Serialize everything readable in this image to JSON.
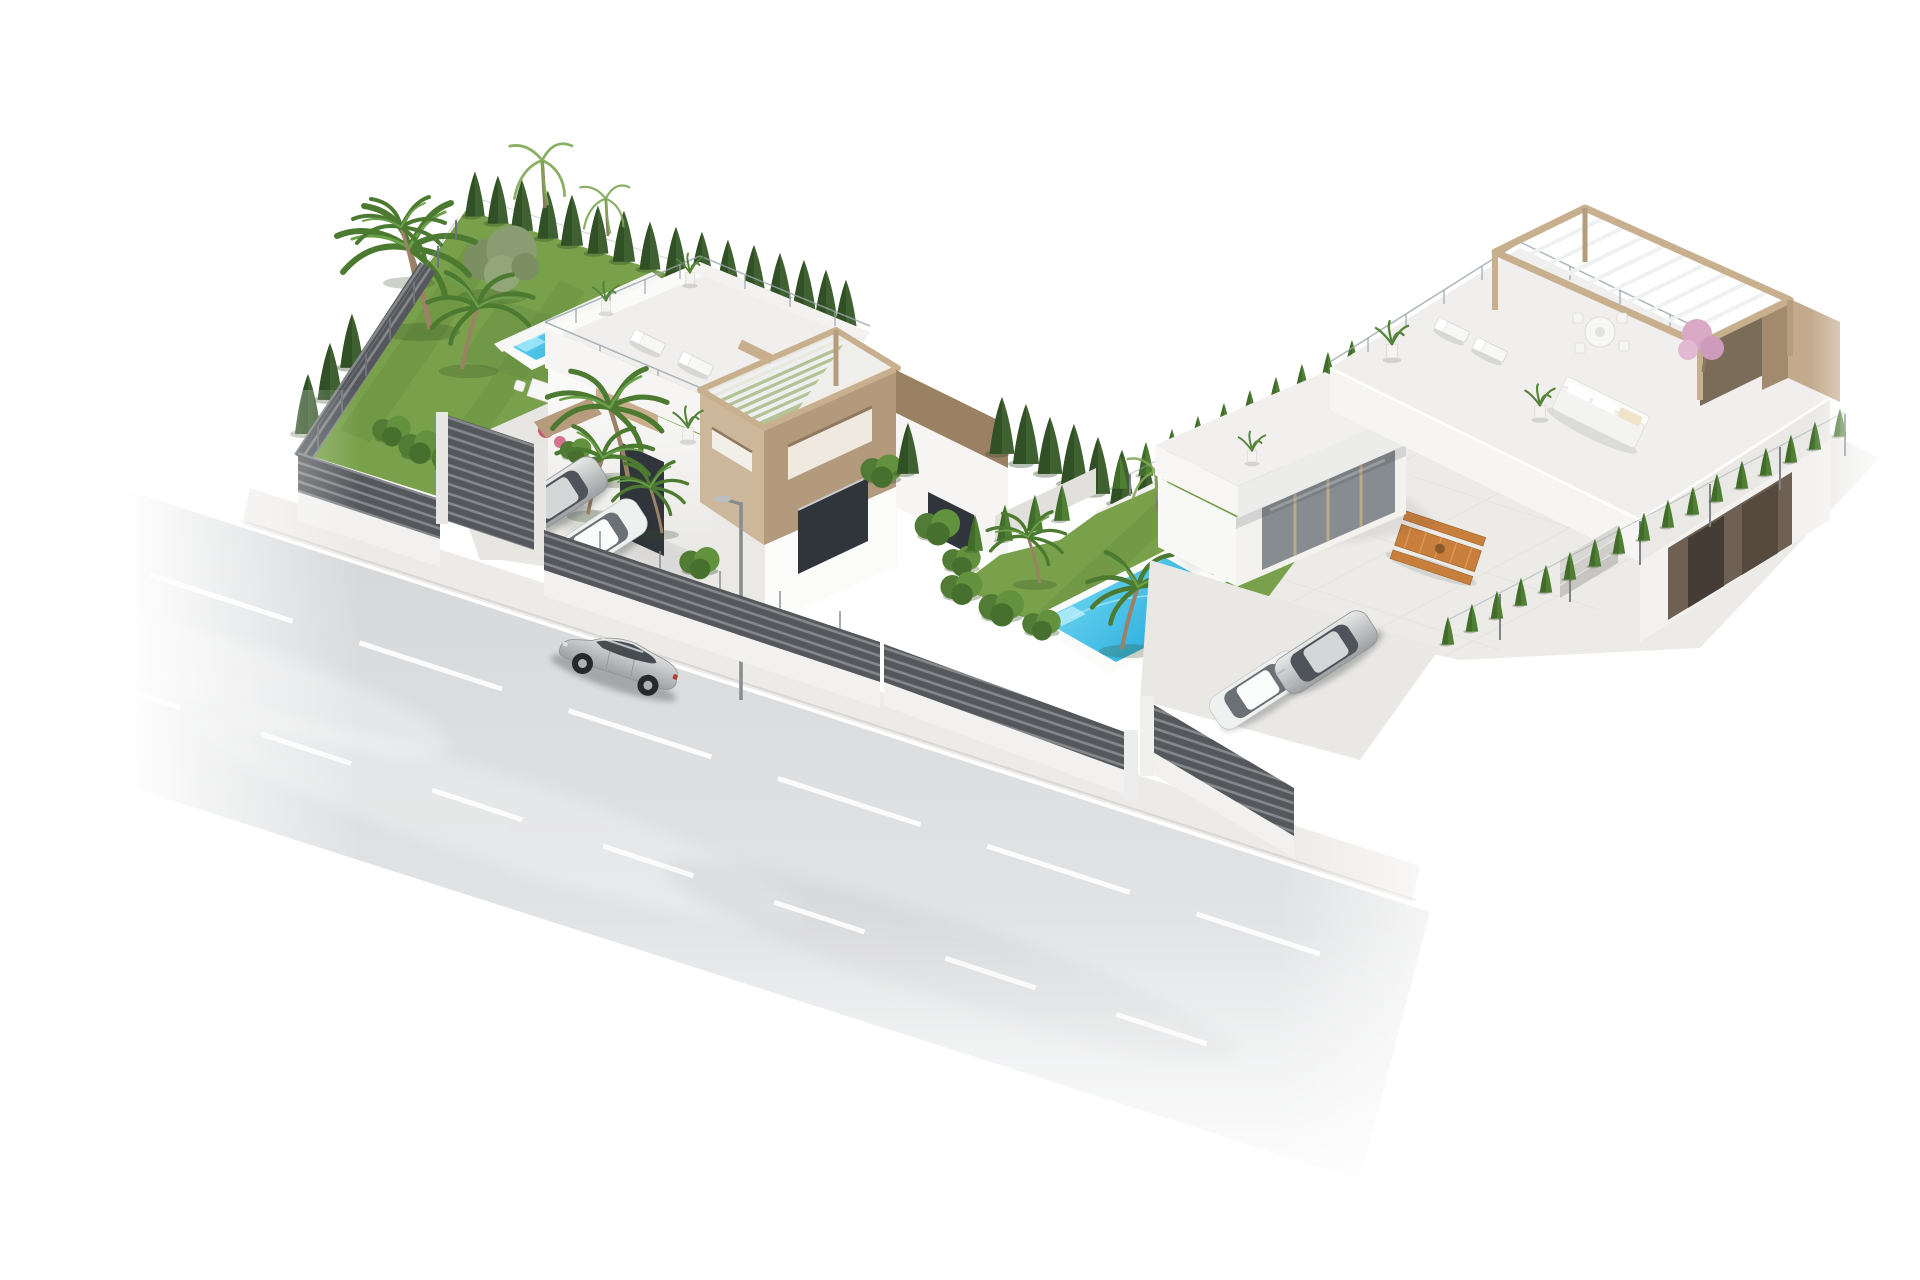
{
  "meta": {
    "image_type": "3d-architectural-render",
    "description": "Aerial axonometric rendering of two modern white villas on a corner plot: left villa with lap pool, lawn garden, palm trees and tan rooftop pergola tower; right villa with rooftop lounge pergola, garden pool, sun terrace; dark slatted privacy fences, sidewalk and asphalt street with a silver sedan driving by."
  },
  "palette": {
    "background": "#ffffff",
    "road_dark": "#d3d5d7",
    "road_light": "#eaebec",
    "sidewalk": "#edebe7",
    "lane_marking": "#ffffff",
    "lawn": "#79a14b",
    "lawn_shade": "#5f8838",
    "cypress": "#3f6030",
    "cypress_dark": "#2f4d24",
    "hedge": "#4e7f33",
    "hedge_dark": "#3f6829",
    "bush": "#63923f",
    "palm_frond": "#4c7a31",
    "palm_trunk": "#9b8266",
    "olive": "#8a9c72",
    "pool_light": "#7fe0f6",
    "pool_deep": "#1ba4d8",
    "pool_deck": "#fbfbfa",
    "wall_white": "#fbfbfa",
    "wall_shade": "#e9e8e5",
    "roof_deck": "#f0efed",
    "fascia": "#f6f5f3",
    "pergola_wood": "#c8b08f",
    "pergola_dark": "#7b6b59",
    "tan_wall": "#cdb79a",
    "tan_wall_dark": "#b39a7d",
    "window_dark": "#30353b",
    "door_brown": "#6e6052",
    "fence_slat": "#54585c",
    "fence_slat_light": "#84888b",
    "fence_base": "#f2f1ef",
    "car_silver_hi": "#e8e9e9",
    "car_silver_lo": "#9da0a2",
    "car_white": "#eff0f0",
    "glass_rail": "#9aa7ad",
    "wood_furniture": "#c97f3c",
    "pink_tree": "#d9a9c6",
    "flower_pink": "#c05a75",
    "shadow": "#2a2e31"
  },
  "scene": {
    "street": {
      "label": "asphalt street with dashed white lane markings, fading at edges"
    },
    "street_car": {
      "label": "silver sedan driving on street"
    },
    "left_villa": {
      "label": "white villa: roof terrace with loungers, tan pergola tower with slot windows, lap pool along back fence, lawn, cypress rows, palm cluster, driveway with two parked cars"
    },
    "right_villa": {
      "label": "white villa: rooftop pergola lounge with dining set and sofa, glass railings, garden pool with bench step, orange sun loungers, wooden picnic table, driveway with two parked cars"
    },
    "fences": {
      "label": "dark gray horizontal-slat fences on white base walls with glass-post toppers"
    },
    "vegetation": {
      "label": "cypress hedges, clipped hedge rows, palms, olive tree, flowering shrubs"
    }
  }
}
